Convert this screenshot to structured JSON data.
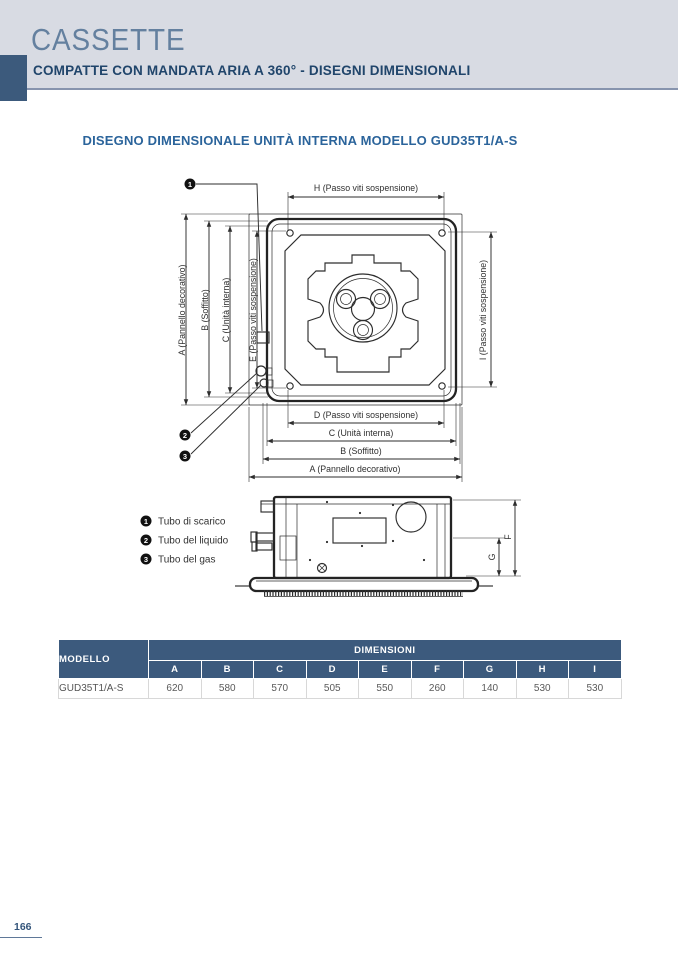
{
  "header": {
    "title": "CASSETTE",
    "subtitle": "COMPATTE CON MANDATA ARIA A 360° - DISEGNI DIMENSIONALI"
  },
  "section": {
    "title": "DISEGNO DIMENSIONALE UNITÀ INTERNA MODELLO GUD35T1/A-S"
  },
  "drawing": {
    "dim_labels": {
      "h": "H (Passo viti sospensione)",
      "i": "I (Passo viti sospensione)",
      "a_left": "A (Pannello decorativo)",
      "b_left": "B (Soffitto)",
      "c_left": "C (Unità interna)",
      "e_left": "E (Passo viti sospensione)",
      "d_bottom": "D (Passo viti sospensione)",
      "c_bottom": "C (Unità interna)",
      "b_bottom": "B (Soffitto)",
      "a_bottom": "A (Pannello decorativo)",
      "f": "F",
      "g": "G"
    },
    "callouts": [
      "1",
      "2",
      "3"
    ],
    "legend": [
      {
        "num": "1",
        "label": "Tubo di scarico"
      },
      {
        "num": "2",
        "label": "Tubo del liquido"
      },
      {
        "num": "3",
        "label": "Tubo del gas"
      }
    ]
  },
  "table": {
    "model_header": "MODELLO",
    "group_header": "DIMENSIONI",
    "columns": [
      "A",
      "B",
      "C",
      "D",
      "E",
      "F",
      "G",
      "H",
      "I"
    ],
    "rows": [
      {
        "model": "GUD35T1/A-S",
        "values": [
          620,
          580,
          570,
          505,
          550,
          260,
          140,
          530,
          530
        ]
      }
    ]
  },
  "footer": {
    "page_number": "166"
  },
  "colors": {
    "accent_dark": "#3c5a7d",
    "band_bg": "#d8dbe3",
    "title_blue": "#2b649b",
    "header_text": "#20456b"
  }
}
